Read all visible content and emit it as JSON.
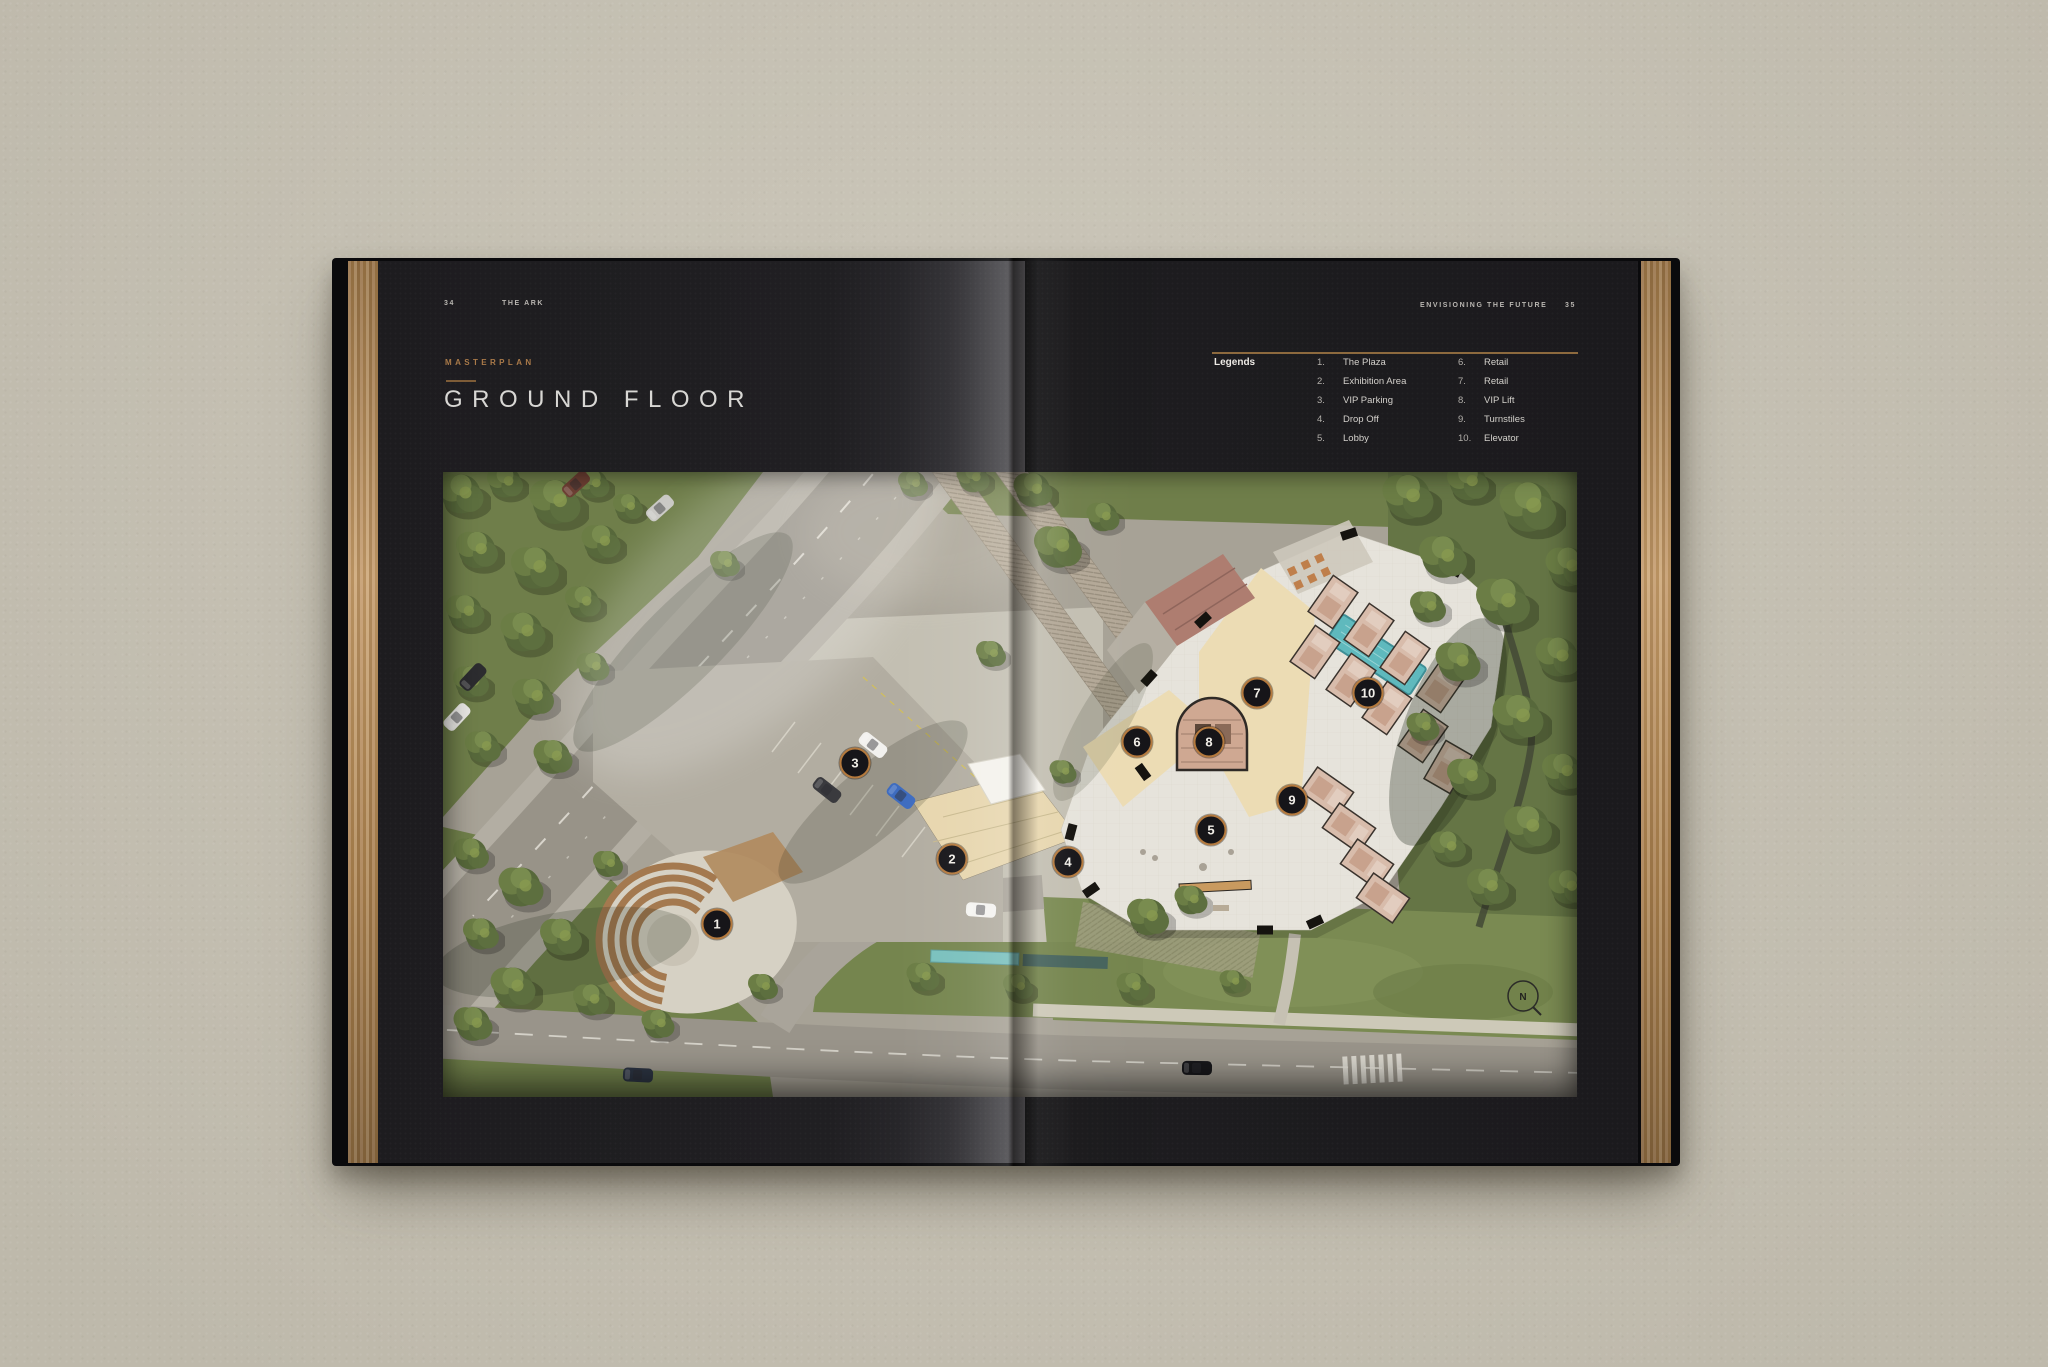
{
  "book": {
    "left_page": {
      "folio": "34",
      "running_header": "THE ARK",
      "eyebrow": "MASTERPLAN",
      "title": "GROUND FLOOR"
    },
    "right_page": {
      "running_header": "ENVISIONING THE FUTURE",
      "folio": "35"
    },
    "legend": {
      "label": "Legends",
      "columns": [
        [
          {
            "num": "1.",
            "label": "The Plaza"
          },
          {
            "num": "2.",
            "label": "Exhibition Area"
          },
          {
            "num": "3.",
            "label": "VIP Parking"
          },
          {
            "num": "4.",
            "label": "Drop Off"
          },
          {
            "num": "5.",
            "label": "Lobby"
          }
        ],
        [
          {
            "num": "6.",
            "label": "Retail"
          },
          {
            "num": "7.",
            "label": "Retail"
          },
          {
            "num": "8.",
            "label": "VIP Lift"
          },
          {
            "num": "9.",
            "label": "Turnstiles"
          },
          {
            "num": "10.",
            "label": "Elevator"
          }
        ]
      ]
    },
    "plan": {
      "compass": "N",
      "markers": [
        {
          "n": "1",
          "x": 274,
          "y": 452
        },
        {
          "n": "2",
          "x": 509,
          "y": 387
        },
        {
          "n": "3",
          "x": 412,
          "y": 291
        },
        {
          "n": "4",
          "x": 625,
          "y": 390
        },
        {
          "n": "5",
          "x": 768,
          "y": 358
        },
        {
          "n": "6",
          "x": 694,
          "y": 270
        },
        {
          "n": "7",
          "x": 814,
          "y": 221
        },
        {
          "n": "8",
          "x": 766,
          "y": 270
        },
        {
          "n": "9",
          "x": 849,
          "y": 328
        },
        {
          "n": "10",
          "x": 925,
          "y": 221
        }
      ]
    },
    "colors": {
      "accent_copper": "#aa7a49",
      "marker_ring": "#b57a3e",
      "foil": "#c59c6e",
      "page_dark": "#1b1a1d",
      "background": "#c9c4b6"
    }
  }
}
